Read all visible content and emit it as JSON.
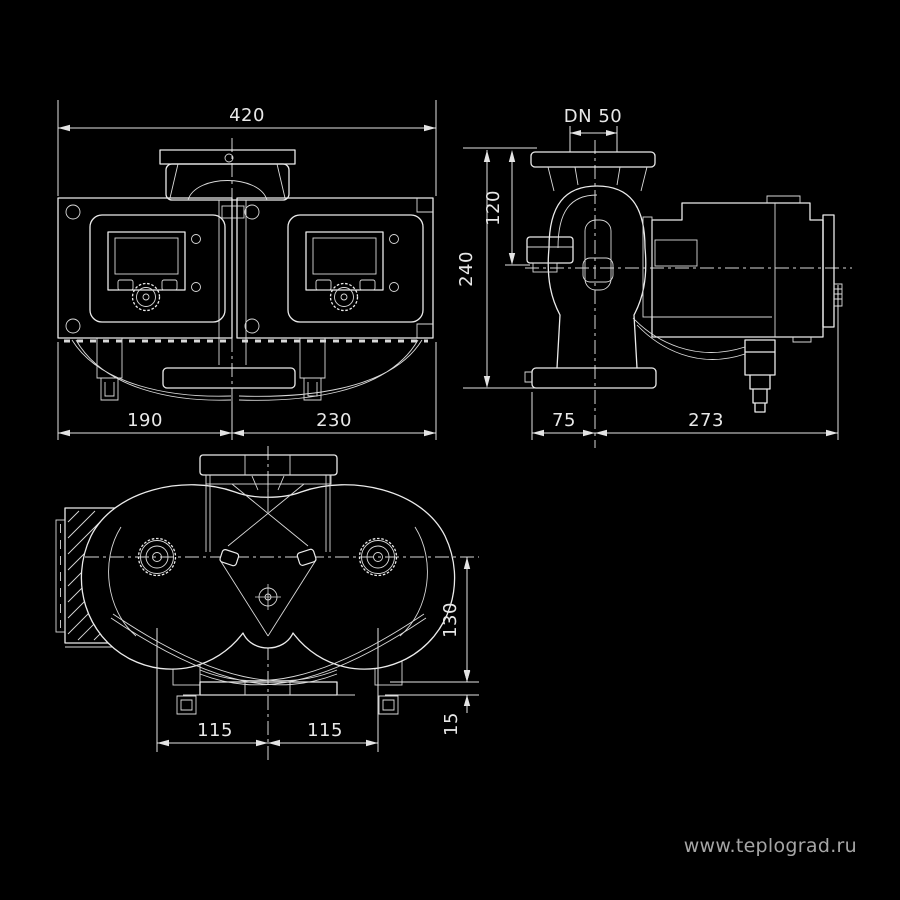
{
  "canvas": {
    "background": "#000000"
  },
  "watermark": {
    "text": "www.teplograd.ru",
    "color": "#a6a6a6"
  },
  "colors": {
    "line": "#ebebeb",
    "dim_text": "#e8e8e8",
    "background": "#000000"
  },
  "views": {
    "front": {
      "dims": {
        "total_width": "420",
        "left_width": "190",
        "right_width": "230"
      }
    },
    "side": {
      "dims": {
        "flange_dn": "DN 50",
        "upper_height": "120",
        "total_height": "240",
        "depth_left": "75",
        "depth_right": "273"
      }
    },
    "top": {
      "dims": {
        "axis_to_base": "130",
        "base_height": "15",
        "spacing_left": "115",
        "spacing_right": "115"
      }
    }
  }
}
